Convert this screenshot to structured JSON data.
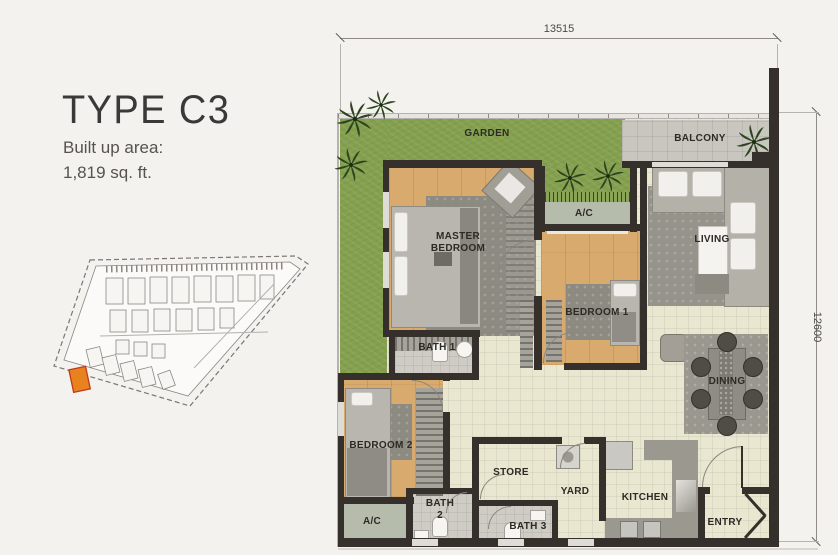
{
  "panel": {
    "title": "TYPE C3",
    "area_label": "Built up area:",
    "area_value": "1,819 sq. ft."
  },
  "dimensions": {
    "top": "13515",
    "right": "12600"
  },
  "rooms": {
    "garden": "GARDEN",
    "balcony": "BALCONY",
    "ac_upper": "A/C",
    "master_bedroom": "MASTER BEDROOM",
    "living": "LIVING",
    "bedroom1": "BEDROOM 1",
    "bath1": "BATH 1",
    "dining": "DINING",
    "bedroom2": "BEDROOM 2",
    "ac_lower": "A/C",
    "bath2": "BATH 2",
    "bath3": "BATH 3",
    "store": "STORE",
    "yard": "YARD",
    "kitchen": "KITCHEN",
    "entry": "ENTRY"
  },
  "icons": {
    "palm_tree": "palm-tree-icon"
  },
  "colors": {
    "wall": "#35302b",
    "garden": "#84a04e",
    "wood": "#d9aa6d",
    "tile": "#e9e7d0",
    "balcony": "#c8c6bf",
    "bath": "#cfccc5",
    "ac": "#b6bcac",
    "counter": "#9b988f",
    "highlight": "#e8821e",
    "text": "#2d2a26"
  }
}
